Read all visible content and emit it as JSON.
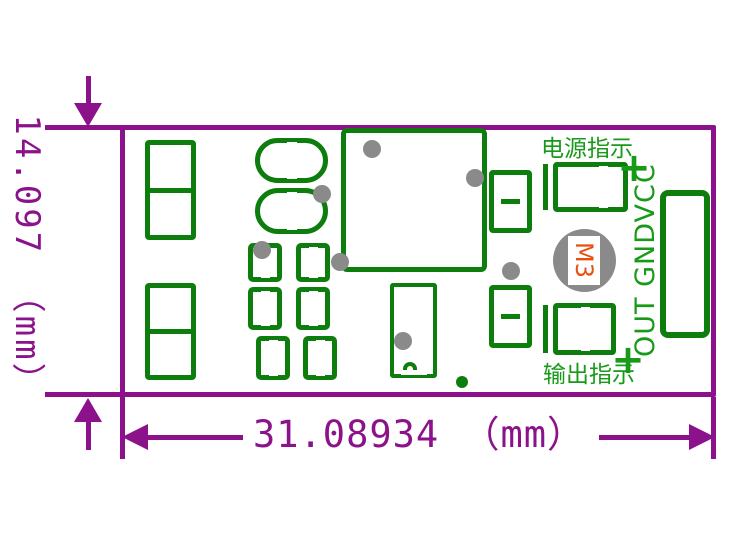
{
  "dimensions": {
    "height_label": "14.097 （mm）",
    "width_label": "31.08934 （mm）"
  },
  "silkscreen": {
    "power_indicator": "电源指示",
    "output_indicator": "输出指示",
    "pin_labels": "OUT GNDVCC",
    "plus_top": "+",
    "plus_bottom": "+",
    "mounting_hole": "M3"
  },
  "colors": {
    "dimension": "#8b128b",
    "copper": "#0d7d0d",
    "silkscreen_text": "#189a18",
    "via": "#8a8a8a",
    "hole_label": "#e8500f",
    "background": "#ffffff"
  },
  "board": {
    "footprints": [
      {
        "name": "pad-left-top",
        "type": "rect2",
        "x": 145,
        "y": 140,
        "w": 51,
        "h": 100
      },
      {
        "name": "pad-left-bottom",
        "type": "rect2",
        "x": 145,
        "y": 283,
        "w": 51,
        "h": 97
      },
      {
        "name": "stadium-pad-top",
        "type": "stadium",
        "x": 255,
        "y": 138,
        "w": 73,
        "h": 45
      },
      {
        "name": "stadium-pad-bottom",
        "type": "stadium",
        "x": 255,
        "y": 188,
        "w": 73,
        "h": 46
      },
      {
        "name": "pad-pair-row1",
        "type": "pair",
        "x": 248,
        "y": 243,
        "w": 82,
        "h": 39
      },
      {
        "name": "pad-pair-row2",
        "type": "pair",
        "x": 248,
        "y": 287,
        "w": 82,
        "h": 43
      },
      {
        "name": "pad-pair-row3",
        "type": "pair",
        "x": 256,
        "y": 336,
        "w": 81,
        "h": 44
      },
      {
        "name": "ic-courtyard",
        "type": "rect",
        "x": 341,
        "y": 128,
        "w": 146,
        "h": 144,
        "stroke": 5,
        "r": 6
      },
      {
        "name": "component-with-notch",
        "type": "notch",
        "x": 390,
        "y": 283,
        "w": 47,
        "h": 95,
        "stroke": 4
      },
      {
        "name": "pad-mid-top",
        "type": "rect2gap",
        "x": 489,
        "y": 170,
        "w": 43,
        "h": 63
      },
      {
        "name": "pad-mid-bottom",
        "type": "rect2gap",
        "x": 489,
        "y": 285,
        "w": 43,
        "h": 63
      },
      {
        "name": "led-power",
        "type": "led",
        "x": 543,
        "y": 162,
        "w": 85,
        "h": 50,
        "gap": 0.68
      },
      {
        "name": "led-output",
        "type": "led",
        "x": 543,
        "y": 303,
        "w": 73,
        "h": 52,
        "gap": 0.52
      },
      {
        "name": "connector-pad",
        "type": "rect",
        "x": 660,
        "y": 190,
        "w": 50,
        "h": 148,
        "stroke": 6,
        "r": 8
      }
    ],
    "vias": [
      [
        372,
        149
      ],
      [
        475,
        178
      ],
      [
        322,
        194
      ],
      [
        262,
        250
      ],
      [
        340,
        262
      ],
      [
        511,
        271
      ],
      [
        403,
        341
      ]
    ],
    "dots": [
      [
        462,
        382
      ]
    ]
  }
}
